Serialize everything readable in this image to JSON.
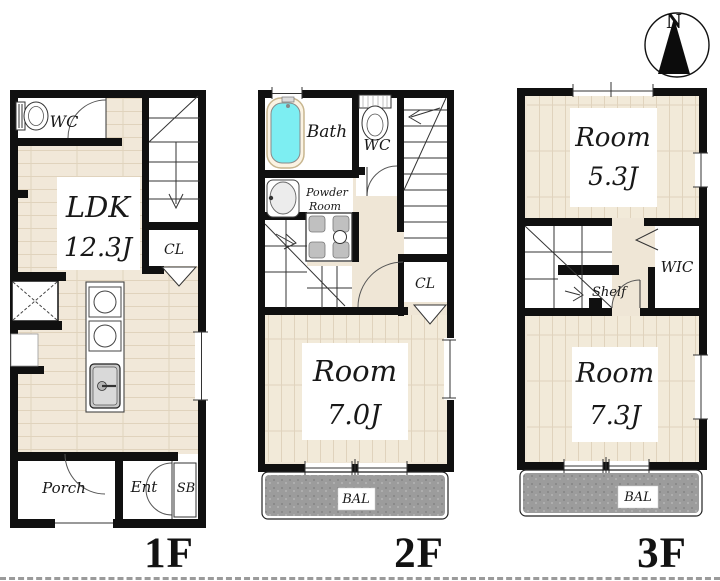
{
  "compass": {
    "north_label": "N"
  },
  "floor1": {
    "label": "1F",
    "wc": "WC",
    "ldk_name": "LDK",
    "ldk_size": "12.3J",
    "closet": "CL",
    "porch": "Porch",
    "entrance": "Ent",
    "shoe_box": "SB"
  },
  "floor2": {
    "label": "2F",
    "bath": "Bath",
    "wc": "WC",
    "powder_line1": "Powder",
    "powder_line2": "Room",
    "closet": "CL",
    "room_name": "Room",
    "room_size": "7.0J",
    "balcony": "BAL"
  },
  "floor3": {
    "label": "3F",
    "room1_name": "Room",
    "room1_size": "5.3J",
    "wic": "WIC",
    "shelf": "Shelf",
    "room2_name": "Room",
    "room2_size": "7.3J",
    "balcony": "BAL"
  },
  "colors": {
    "wall": "#101010",
    "floor_beige": "#f1e8d9",
    "bathtub_cyan": "#7deef2",
    "balcony_gray": "#9c9c9c"
  }
}
